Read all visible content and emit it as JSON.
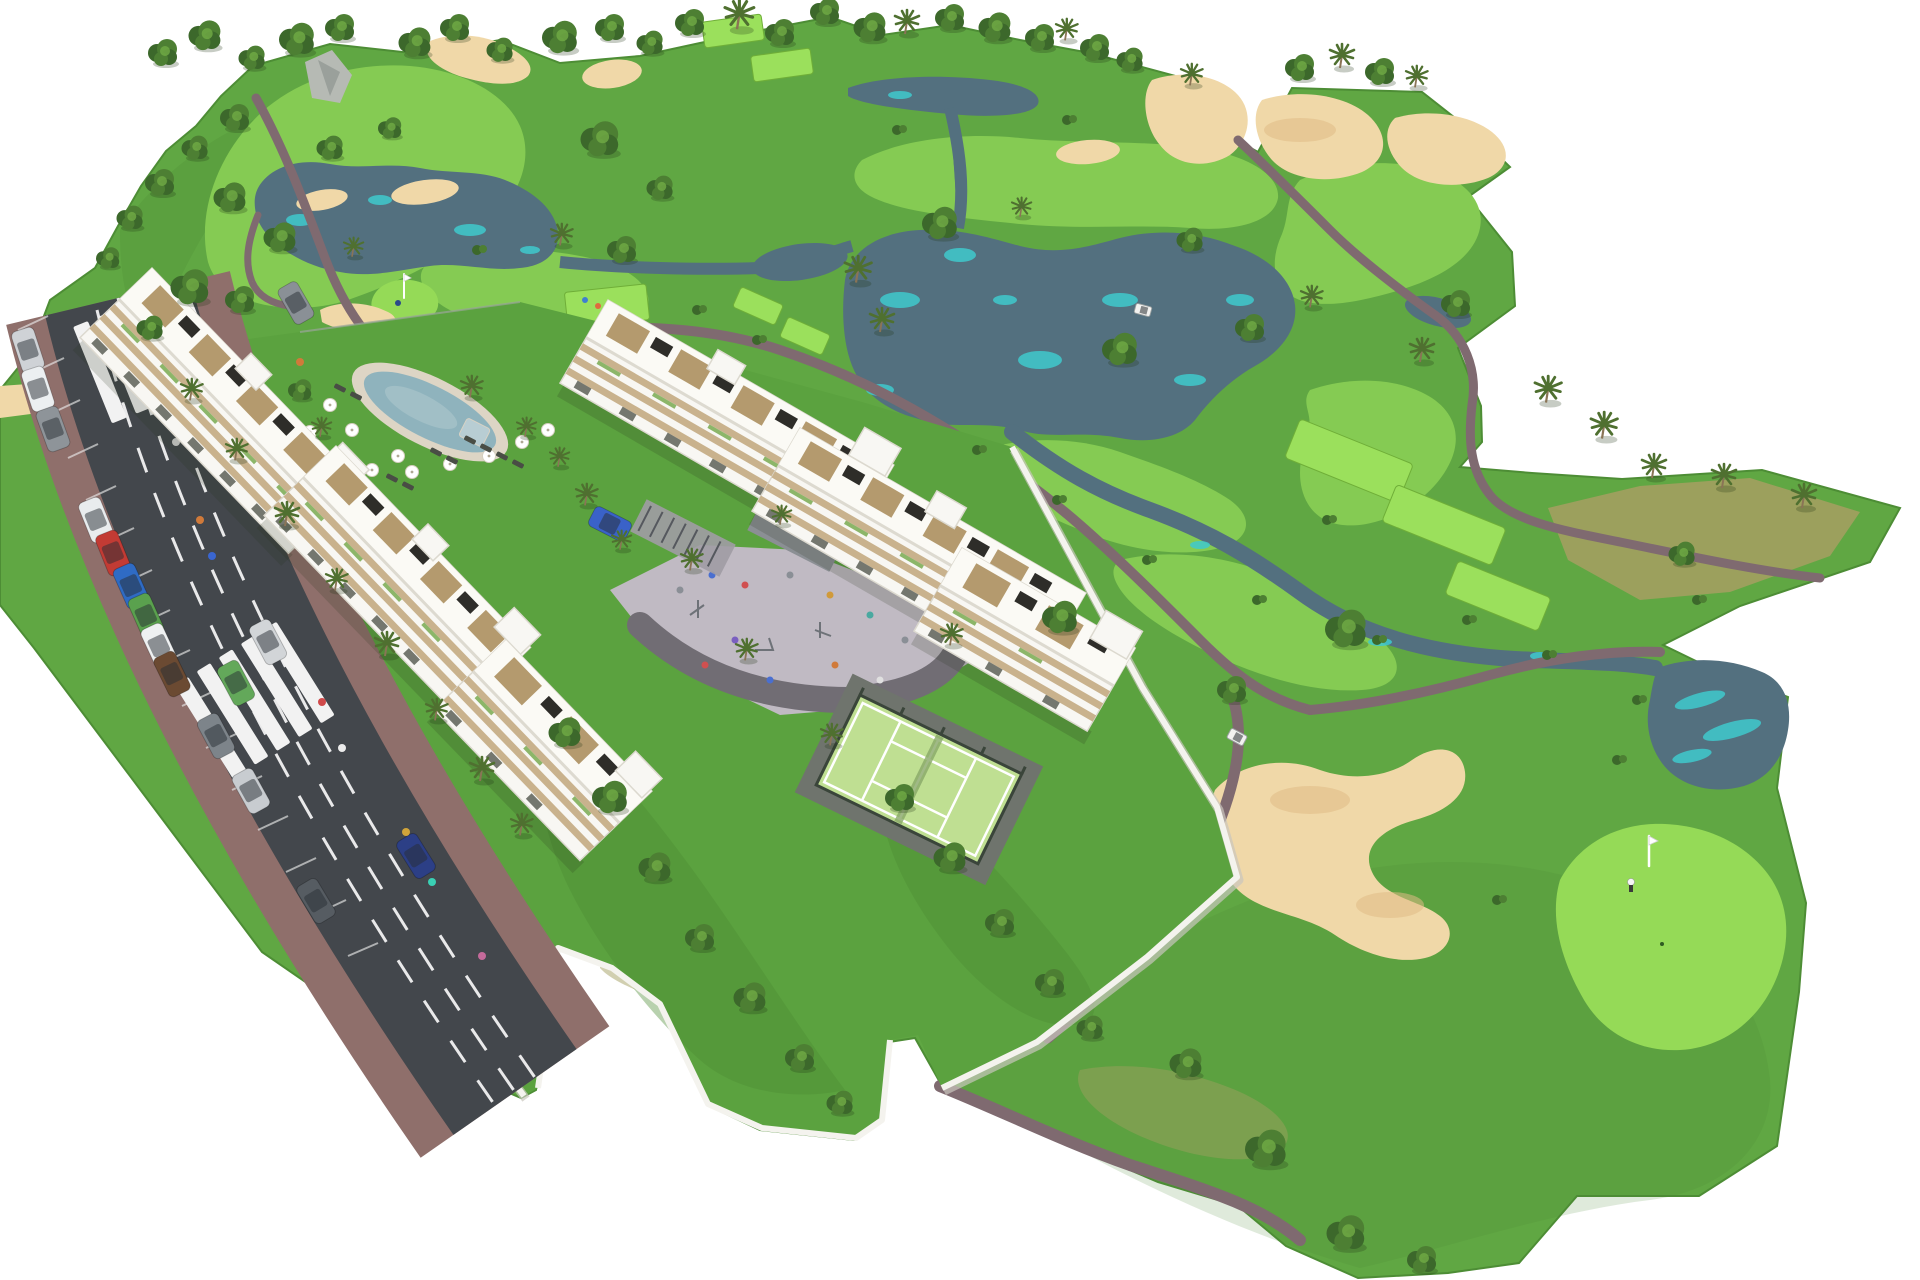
{
  "meta": {
    "title": "Aerial 3D masterplan rendering of a white modern apartment complex beside a golf course",
    "type": "architectural-visualization",
    "view": "bird's-eye / isometric aerial"
  },
  "palette": {
    "bg": "#ffffff",
    "grassBase": "#60a743",
    "grassDark": "#4d8d35",
    "grassLight": "#79c24f",
    "fairway": "#85cb53",
    "green": "#95da57",
    "teeGreen": "#9be05c",
    "dryGrass": "#a3a061",
    "sand": "#f0d8a8",
    "sandShade": "#e0bb85",
    "waterDark": "#53707f",
    "waterTeal": "#3fc9cc",
    "poolWater": "#8fb3bd",
    "poolDeck": "#ddd5c5",
    "path": "#7f6a70",
    "asphalt": "#43474c",
    "sidewalk": "#8f6f6b",
    "roadWhite": "#f2f2f2",
    "wall": "#f4f3ee",
    "wallShade": "#c9c6bd",
    "bldgWhite": "#f8f7f3",
    "bldgShade": "#dcd9cf",
    "bldgBeige": "#c9b28d",
    "bldgWood": "#b49a6e",
    "darkPanel": "#2e2d29",
    "glass": "#5d6057",
    "treeDark": "#3c682b",
    "treeMid": "#4d7f33",
    "treeLight": "#6fa844",
    "palmGreen": "#4f7030",
    "trunk": "#8a7456",
    "plaza": "#c0bac3",
    "plazaBand": "#716d74",
    "padel": "#bfdf92",
    "fence": "#3a453a",
    "rock": "#b6bab4"
  },
  "scene": {
    "description": "Two stepped rows of white 4-storey apartment blocks with wood-trimmed terraces and rooftop decks sit between a tree-lined avenue (parked cars, zebra crossings, red-brick sidewalks) and an 18-hole style golf course with lakes, sand bunkers, bright fairways, tee boxes, putting greens with flags, a communal pool with parasols, a central playground plaza and a fenced padel court.",
    "counts": {
      "apartment_blocks": 6,
      "swimming_pools": 1,
      "padel_courts": 1,
      "playground_plazas": 1,
      "golf_flags": 2,
      "lakes_ponds": 4,
      "sand_bunkers": 9,
      "tee_boxes": 8,
      "crosswalks": 2,
      "cars": 17,
      "golf_carts": 2
    },
    "cars": [
      {
        "label": "parked silver",
        "color": "#cfd2d6"
      },
      {
        "label": "parked white",
        "color": "#eceff1"
      },
      {
        "label": "parked gray",
        "color": "#8e9499"
      },
      {
        "label": "parked white",
        "color": "#e9ecee"
      },
      {
        "label": "parked red",
        "color": "#c23b34"
      },
      {
        "label": "parked blue",
        "color": "#2f6bc4"
      },
      {
        "label": "parked green",
        "color": "#5aa14e"
      },
      {
        "label": "parked white",
        "color": "#eff1f2"
      },
      {
        "label": "parked gray",
        "color": "#7d848a"
      },
      {
        "label": "parked silver",
        "color": "#c8ccd0"
      },
      {
        "label": "parked dark gray",
        "color": "#565c62"
      },
      {
        "label": "driving green",
        "color": "#63a85a"
      },
      {
        "label": "driving silver",
        "color": "#d2d5d8"
      },
      {
        "label": "driving dark blue",
        "color": "#2c3f86"
      },
      {
        "label": "courtyard blue",
        "color": "#3a62c8"
      },
      {
        "label": "service gray",
        "color": "#8a9096"
      },
      {
        "label": "parked brown",
        "color": "#6b4a32"
      }
    ],
    "golfers": [
      {
        "location": "left putting green",
        "shirt": "#2b4a8a"
      },
      {
        "location": "right putting green",
        "shirt": "#f5f5f5"
      }
    ]
  }
}
